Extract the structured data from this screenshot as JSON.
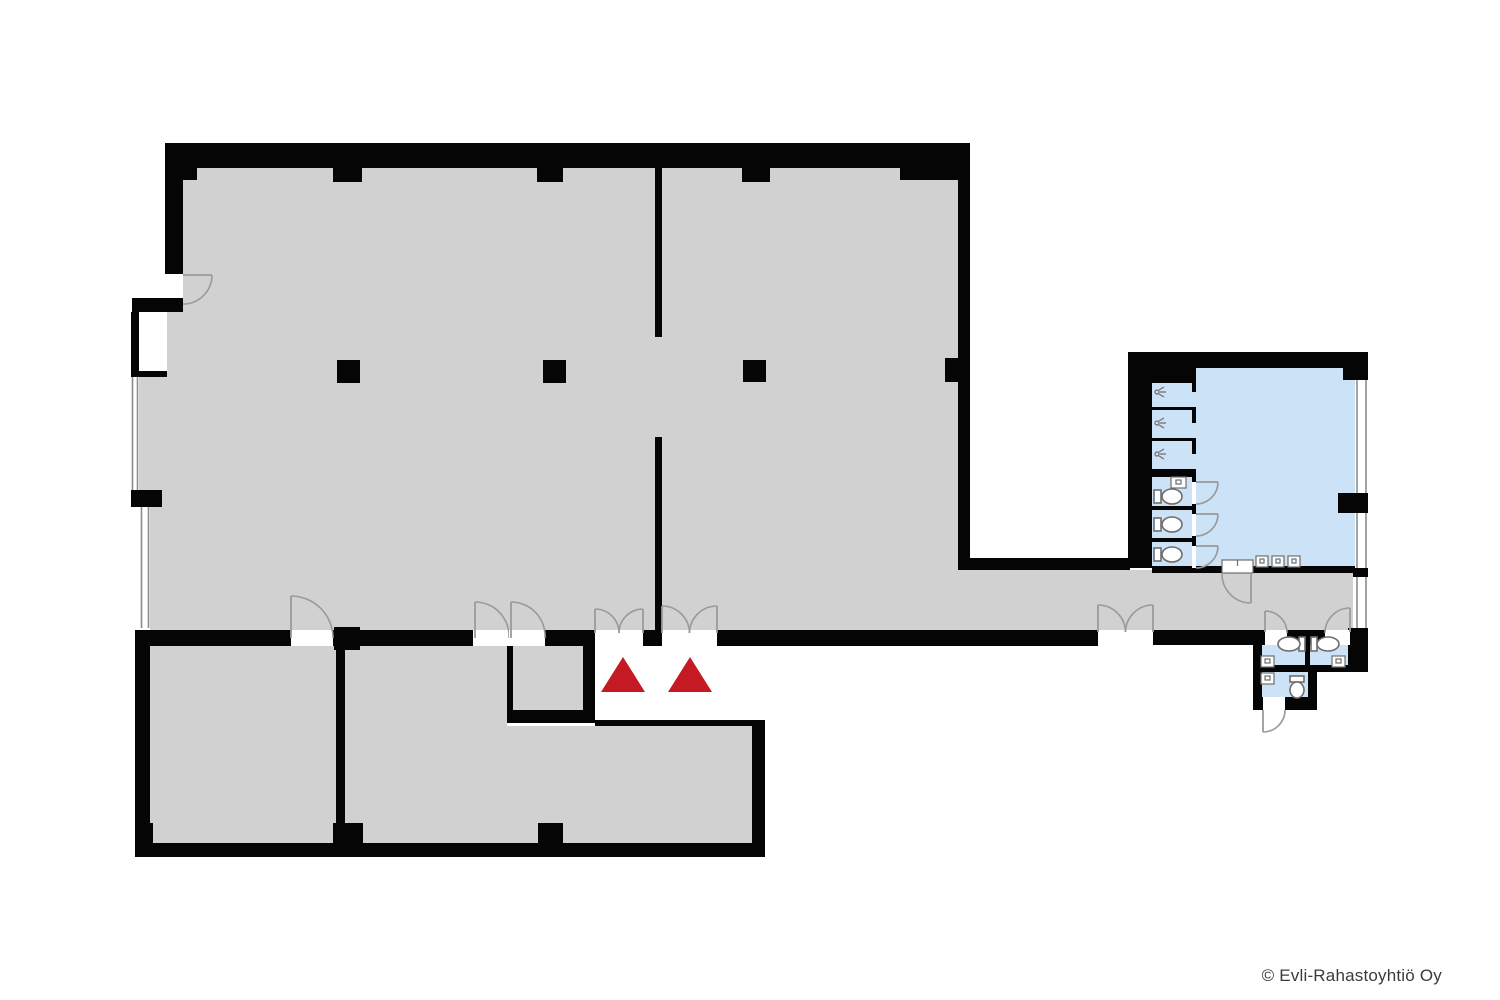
{
  "page": {
    "copyright": "© Evli-Rahastoyhtiö Oy"
  },
  "colors": {
    "wall": "#050505",
    "floor": "#d1d1d1",
    "wet": "#cce2f6",
    "arrow": "#c51a24",
    "door": "#9a9a9a",
    "window": "#8c8c8c",
    "fixture": "#6e6e6e",
    "text": "#3b3b3b",
    "bg": "#ffffff"
  },
  "plan": {
    "type": "floor-plan",
    "areas": [
      {
        "name": "main-hall",
        "fill": "floor"
      },
      {
        "name": "corridor",
        "fill": "floor"
      },
      {
        "name": "room-bottom-left-1",
        "fill": "floor"
      },
      {
        "name": "room-bottom-left-2",
        "fill": "floor"
      },
      {
        "name": "storage-closet",
        "fill": "floor"
      },
      {
        "name": "room-bottom-3",
        "fill": "floor"
      },
      {
        "name": "washroom",
        "fill": "wet"
      },
      {
        "name": "shower-stalls",
        "fill": "wet",
        "count": 3
      },
      {
        "name": "wc-stalls",
        "fill": "wet",
        "count": 3
      },
      {
        "name": "wc-room-1",
        "fill": "wet"
      },
      {
        "name": "wc-room-2",
        "fill": "wet"
      },
      {
        "name": "wc-room-3",
        "fill": "wet"
      }
    ],
    "fixtures": {
      "toilets": 6,
      "sinks": 6,
      "showers": 3
    },
    "entrance_markers": 2,
    "doors": {
      "single": 12,
      "double": 3
    },
    "columns": 3,
    "windows": 5
  }
}
